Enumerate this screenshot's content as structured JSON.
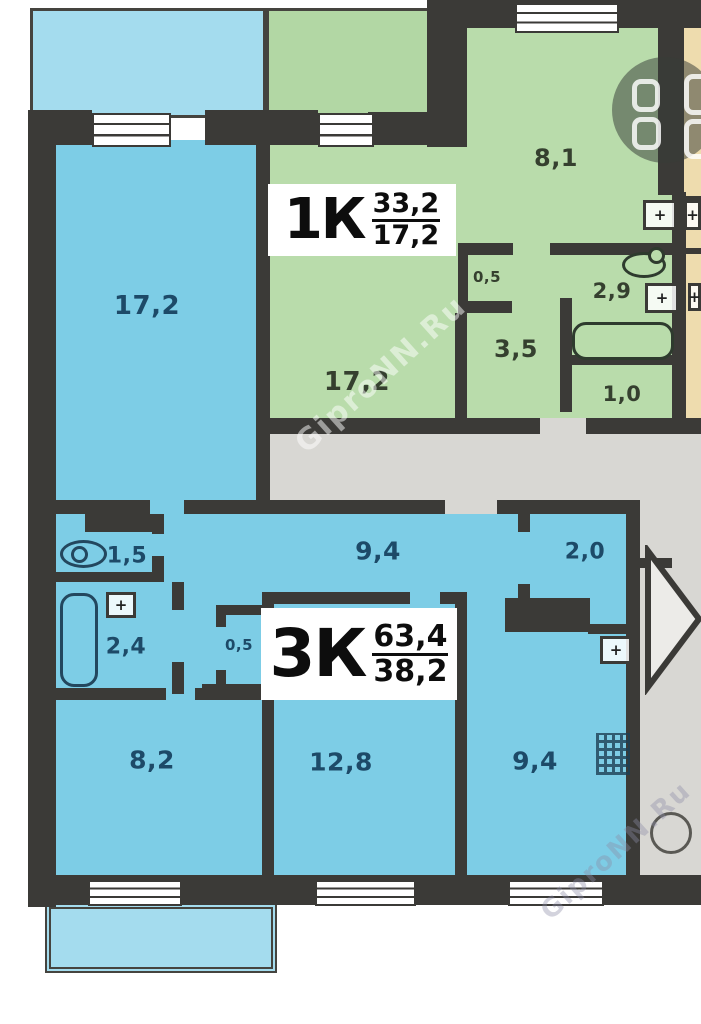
{
  "plan": {
    "watermark": "GiproNN.Ru",
    "stamps": {
      "apt1": {
        "name": "1К",
        "area_total": "33,2",
        "area_living": "17,2"
      },
      "apt3": {
        "name": "3К",
        "area_total": "63,4",
        "area_living": "38,2"
      }
    },
    "rooms": {
      "room_blue_17_2": "17,2",
      "room_green_17_2": "17,2",
      "kitchen_8_1": "8,1",
      "closet_0_5_green": "0,5",
      "bath_2_9": "2,9",
      "hall_3_5": "3,5",
      "wc_1_0": "1,0",
      "hall_9_4": "9,4",
      "closet_2_0": "2,0",
      "wc_1_5": "1,5",
      "bath_2_4": "2,4",
      "closet_0_5_blue": "0,5",
      "room_8_2": "8,2",
      "room_12_8": "12,8",
      "room_9_4": "9,4"
    },
    "icons": {
      "plus": "+",
      "logo": "grid-of-four-rounded-squares",
      "stairs": "stairs-direction-arrow"
    },
    "palette": {
      "wall": "#3b3a37",
      "blue_room": "#7dcde6",
      "blue_balcony": "#a4dcee",
      "green_room": "#b9dcab",
      "green_balcony": "#b2d7a4",
      "beige": "#eedcae",
      "common_gray": "#d8d7d3",
      "blue_text": "#1d4a68",
      "green_text": "#35402f"
    }
  }
}
